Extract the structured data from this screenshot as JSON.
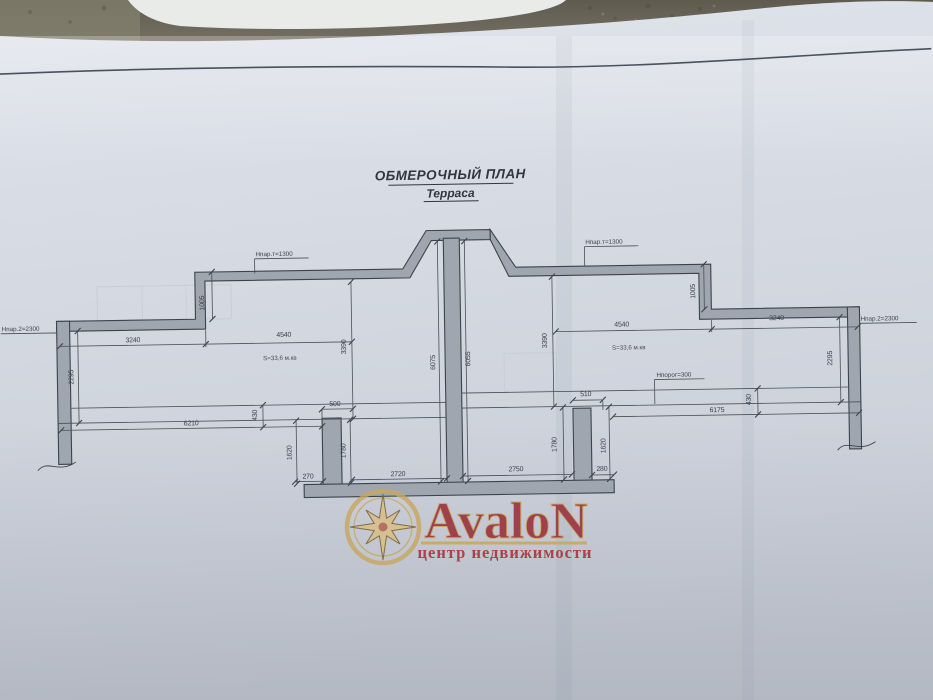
{
  "photo": {
    "background_color": "#6e695d",
    "paper_color": "#d4d9e2",
    "ink_color": "#3e434b"
  },
  "document": {
    "title": "ОБМЕРОЧНЫЙ ПЛАН",
    "subtitle": "Терраса"
  },
  "plan": {
    "wall_fill": "#a0a6b0",
    "annotations": {
      "left_parapet_note": "Нпар.т=1300",
      "right_parapet_note": "Нпар.т=1300",
      "left_wall_note": "Нпар.2=2300",
      "right_wall_note": "Нпар.2=2300",
      "left_area": "S=33,6 м.кв",
      "right_area": "S=33,6 м.кв",
      "threshold_note": "Нпорог=300"
    },
    "dimensions": {
      "left_top_outer": "3240",
      "left_top_inner": "4540",
      "left_step": "1005",
      "left_wall": "2295",
      "left_depth": "3390",
      "left_ledge": "430",
      "left_bottom": "6210",
      "left_pillar_left": "1620",
      "left_pillar_offset": "270",
      "left_pillar_width": "500",
      "left_pillar_right": "1780",
      "left_opening": "2720",
      "center_left": "6075",
      "center_right": "6055",
      "right_opening": "2750",
      "right_pillar_left": "1780",
      "right_pillar_width": "510",
      "right_pillar_offset": "280",
      "right_pillar_right": "1620",
      "right_bottom": "6175",
      "right_ledge": "430",
      "right_wall": "2295",
      "right_depth": "3390",
      "right_top_inner": "4540",
      "right_top_outer": "3240",
      "right_step": "1005"
    }
  },
  "watermark": {
    "brand": "AvaloN",
    "tagline": "центр недвижимости",
    "gold_color": "#c9a75e",
    "red_color": "#9c333c"
  }
}
